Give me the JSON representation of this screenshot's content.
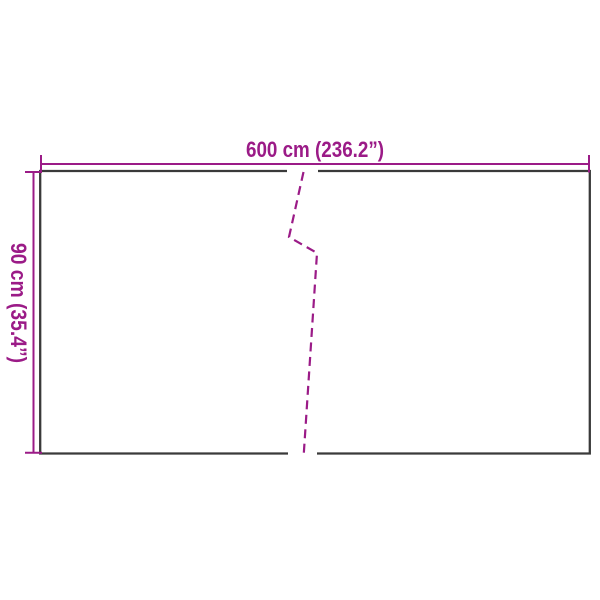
{
  "diagram": {
    "type": "product-dimension-diagram",
    "width_label": "600 cm (236.2”)",
    "height_label": "90 cm (35.4”)",
    "width_value_cm": 600,
    "width_value_inch": 236.2,
    "height_value_cm": 90,
    "height_value_inch": 35.4
  },
  "colors": {
    "dimension_magenta": "#9B1B87",
    "outline_dark": "#3A3A3A",
    "background": "#FFFFFF"
  }
}
